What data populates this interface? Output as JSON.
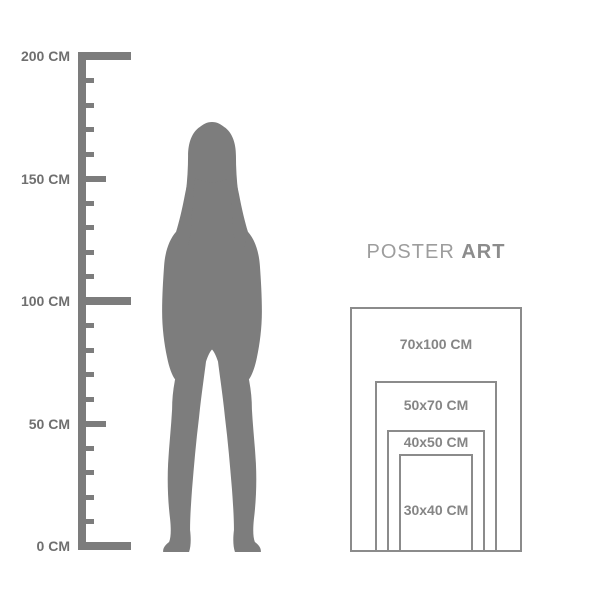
{
  "brand": {
    "name_regular": "POSTER",
    "name_bold": "ART"
  },
  "ruler": {
    "unit_suffix": "CM",
    "tick_step_cm": 10,
    "medium_step_cm": 50,
    "major_step_cm": 100,
    "max_cm": 200,
    "major_labels": [
      {
        "cm": 200,
        "label": "200 CM"
      },
      {
        "cm": 150,
        "label": "150 CM"
      },
      {
        "cm": 100,
        "label": "100 CM"
      },
      {
        "cm": 50,
        "label": "50 CM"
      },
      {
        "cm": 0,
        "label": "0 CM"
      }
    ]
  },
  "figure": {
    "description": "standing woman silhouette with long hair",
    "approx_height_cm": 173
  },
  "poster_sizes": [
    {
      "label": "70x100 CM",
      "width_cm": 70,
      "height_cm": 100
    },
    {
      "label": "50x70 CM",
      "width_cm": 50,
      "height_cm": 70
    },
    {
      "label": "40x50 CM",
      "width_cm": 40,
      "height_cm": 50
    },
    {
      "label": "30x40 CM",
      "width_cm": 30,
      "height_cm": 40
    }
  ],
  "colors": {
    "background": "#ffffff",
    "ruler_gray": "#7c7c7c",
    "ruler_label_gray": "#6f6f6f",
    "silhouette_gray": "#7d7d7d",
    "rect_border_gray": "#8b8b8b",
    "size_label_gray": "#858585",
    "brand_light_gray": "#9d9d9d",
    "brand_dark_gray": "#8c8c8c"
  }
}
